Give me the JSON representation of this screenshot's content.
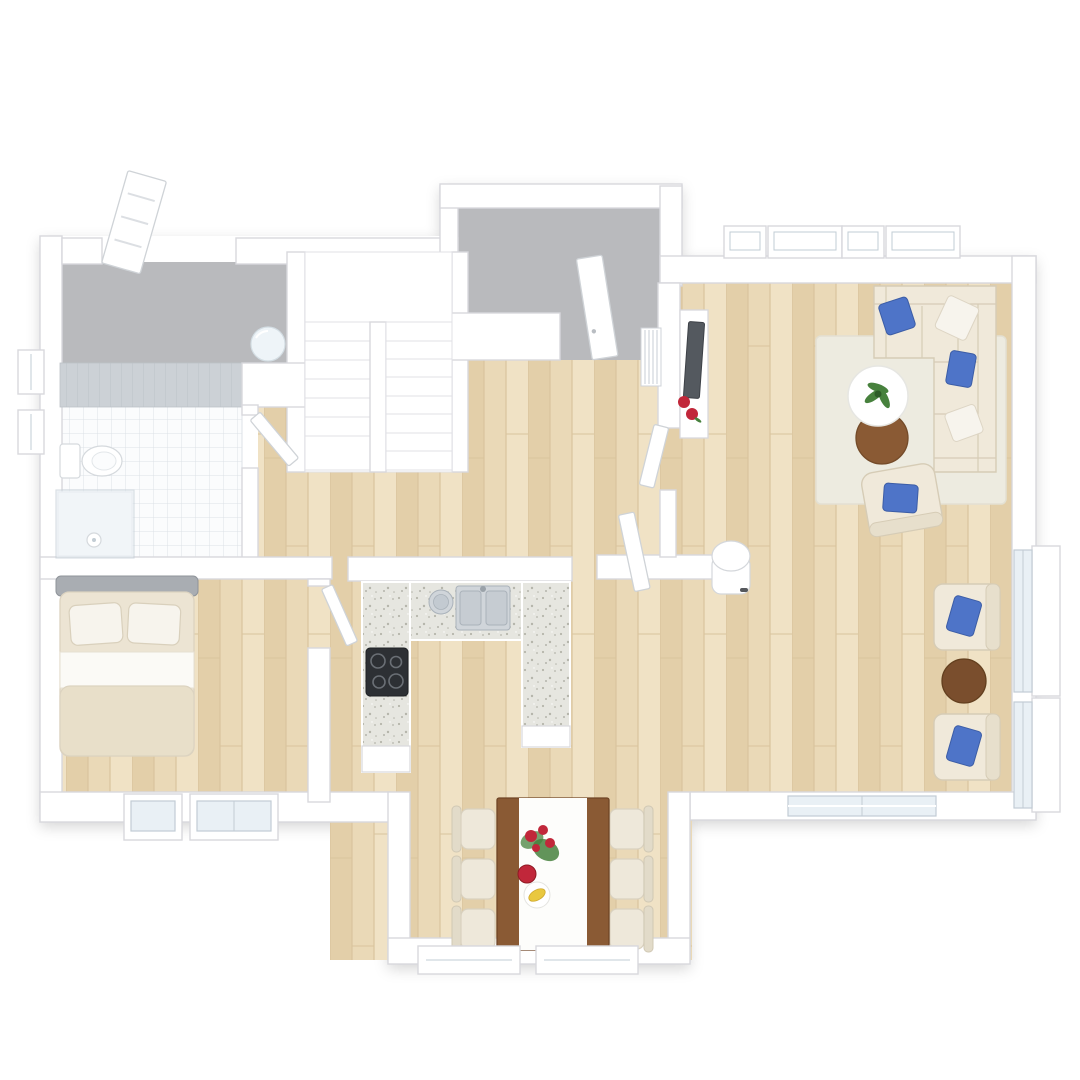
{
  "scene": {
    "type": "3d-floor-plan",
    "view": "top-down",
    "floors_note": "single storey plan, no visible text labels",
    "colors": {
      "background": "#ffffff",
      "wall_fill": "#ffffff",
      "wall_stroke": "#d8d8dd",
      "leaf_stroke": "#cfd3d7",
      "wood_base": "#ead9b7",
      "wood_mid": "#e3cfa9",
      "wood_light": "#f0e2c5",
      "wood_seam": "#d9c49d",
      "gray_floor": "#b9babd",
      "tile_floor": "#fbfcfd",
      "tile_line": "#dde2e7",
      "tiled_wall": "#ccd1d6",
      "tiled_wall_line": "#bcc2c8",
      "counter_base": "#e6e6e0",
      "counter_dot": "#b5b5ab",
      "cooktop": "#2d3034",
      "steel": "#d0d5da",
      "sofa_fill": "#f0e9da",
      "sofa_stroke": "#d6ccb6",
      "pillow_blue": "#4e74c8",
      "pillow_white": "#f7f4ed",
      "rug": "#edebe0",
      "coffee_brown": "#8a5a34",
      "side_brown": "#7a4e2d",
      "chair_cream": "#eee8da",
      "bed_headboard": "#a9adb2",
      "bed_mattress": "#ece4d3",
      "bed_sheet": "#fbfaf6",
      "bed_blanket": "#e8dfc9",
      "tv_dark": "#54595f",
      "red_accent": "#c1273a",
      "green_accent": "#47813d",
      "yellow_accent": "#e9c83f",
      "washer_fill": "#eef4f8",
      "glass_fill": "#e9f0f5",
      "glass_stroke": "#c2ccd4",
      "table_brown": "#8a5a34",
      "runner_white": "#fdfdfb"
    },
    "rooms": [
      {
        "name": "entry-porch",
        "floor": "gray",
        "features": [
          "front-door-open"
        ]
      },
      {
        "name": "utility-room",
        "floor": "gray",
        "features": [
          "side-door-open",
          "round-basin"
        ]
      },
      {
        "name": "bathroom",
        "floor": "white-tile",
        "fixtures": [
          "wall-hung-toilet",
          "walk-in-glass-shower",
          "tiled-wall",
          "window"
        ]
      },
      {
        "name": "bedroom",
        "floor": "wood",
        "furniture": [
          "double-bed",
          "two-pillows"
        ],
        "windows": 2
      },
      {
        "name": "hallway",
        "floor": "wood",
        "features": [
          "u-shaped-staircase",
          "radiator",
          "round-stool"
        ]
      },
      {
        "name": "kitchen",
        "floor": "wood",
        "features": [
          "u-shaped-terrazzo-counter",
          "cooktop-4-burners",
          "double-sink",
          "steel-canister"
        ]
      },
      {
        "name": "dining-area",
        "floor": "wood",
        "furniture": [
          "wood-table-white-runner",
          "six-chairs",
          "red-flowers",
          "red-bowl",
          "banana-plate"
        ],
        "bay_windows": 2
      },
      {
        "name": "living-room",
        "floor": "wood",
        "furniture": [
          "l-shaped-sectional-sofa",
          "blue-pillows",
          "white-coffee-table",
          "brown-coffee-table",
          "potted-plant",
          "area-rug",
          "accent-armchair",
          "two-armchairs-right",
          "round-side-table",
          "tv-console",
          "tv"
        ],
        "windows_top": 4,
        "windows_right": 2,
        "sliding-door-bottom": 1
      }
    ]
  }
}
